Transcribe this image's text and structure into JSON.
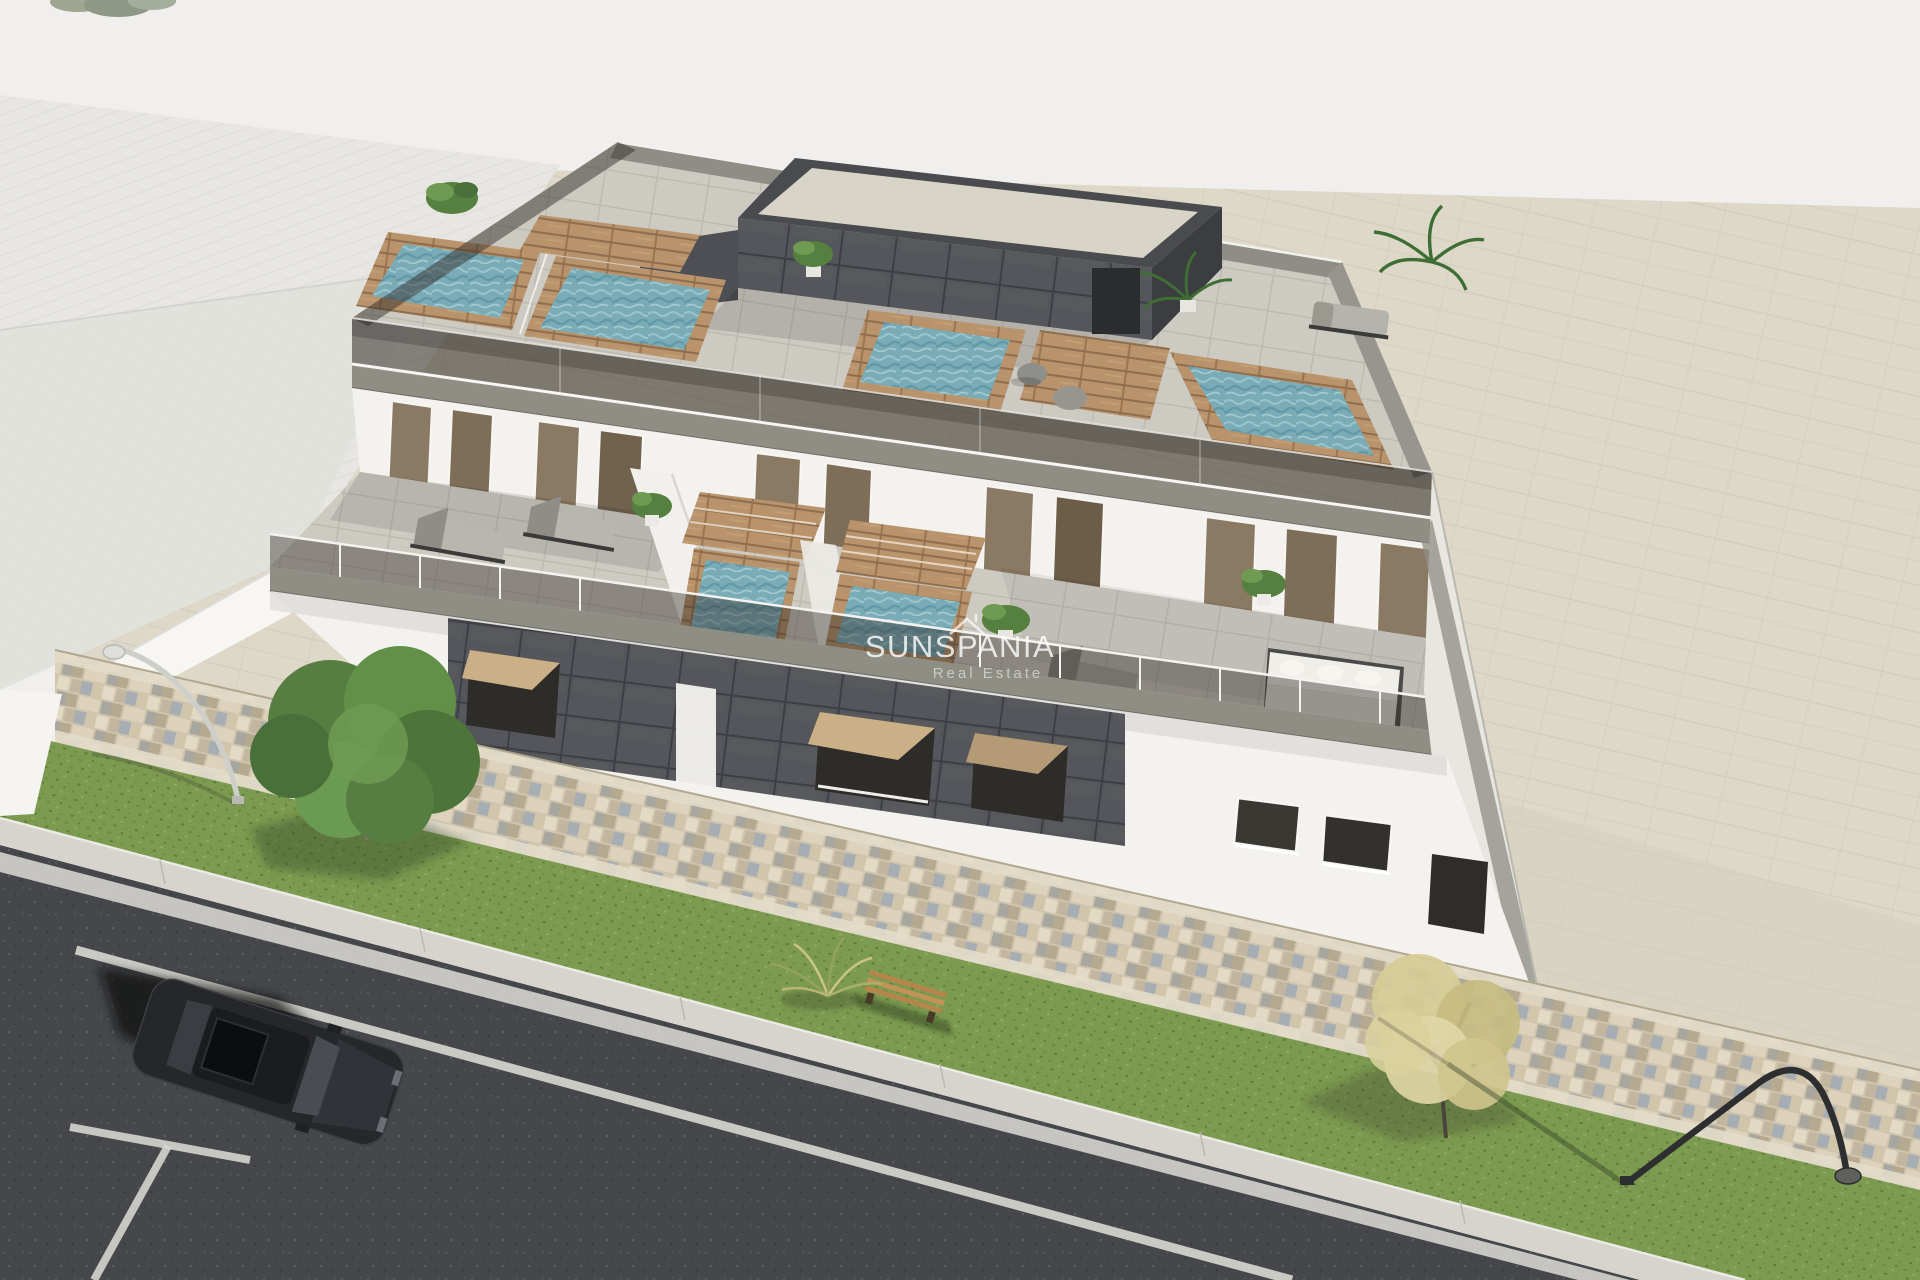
{
  "meta": {
    "type": "architectural-3d-render",
    "description": "Aerial 3D architectural rendering of a modern three-storey apartment block with rooftop plunge pools, wooden pool decks, glass balustrades, furnished terraces, an anthracite tiled facade feature wall, a cobblestone sidewalk, grass verges, two street lamps, two trees, a wooden bench and a dark car parked on the asphalt road"
  },
  "watermark": {
    "title": "SUNSPANIA",
    "subtitle": "Real Estate",
    "icon": "roof-icon"
  },
  "palette": {
    "background": "#f0efed",
    "ground_beige": "#ded8c8",
    "ground_beige_dark": "#d5cfbe",
    "neighbor_roof": "#e7e6e2",
    "neighbor_roof_dark": "#e1e0dc",
    "facade_white": "#f3f2ee",
    "fascia_gray": "#8f8e84",
    "anthracite_tile": "#55565b",
    "glass_dark": "#2f2b27",
    "window_bronze": "#8a7963",
    "pool_water": "#7aacb8",
    "wood_deck": "#b8936b",
    "terrace_floor": "#cdcac2",
    "penthouse_roof": "#d8d4c8",
    "grass": "#7c9b50",
    "pavers": "#cfc5ae",
    "asphalt": "#45474a",
    "curb": "#d6d4cd",
    "road_marking": "#e0e0db",
    "car_body": "#26272a",
    "tree_green": "#567e41",
    "tree_autumn": "#d3c78c",
    "watermark_white": "#ffffff"
  },
  "scene": {
    "building": "modern white apartment building, three levels, flat roof",
    "counts": {
      "rooftop_pools": 4,
      "terrace_plunge_pools": 2,
      "rooftop_poufs": 2,
      "rooftop_loungers": 1,
      "terrace_loungers": 3,
      "corner_sofas": 1,
      "coffee_tables": 1,
      "benches": 1,
      "street_lamps": 2,
      "trees": 2,
      "cars": 1
    },
    "street": "asphalt road with white lane and parking-bay markings, light curb, grass verge and multicolored cobblestone walkway"
  }
}
